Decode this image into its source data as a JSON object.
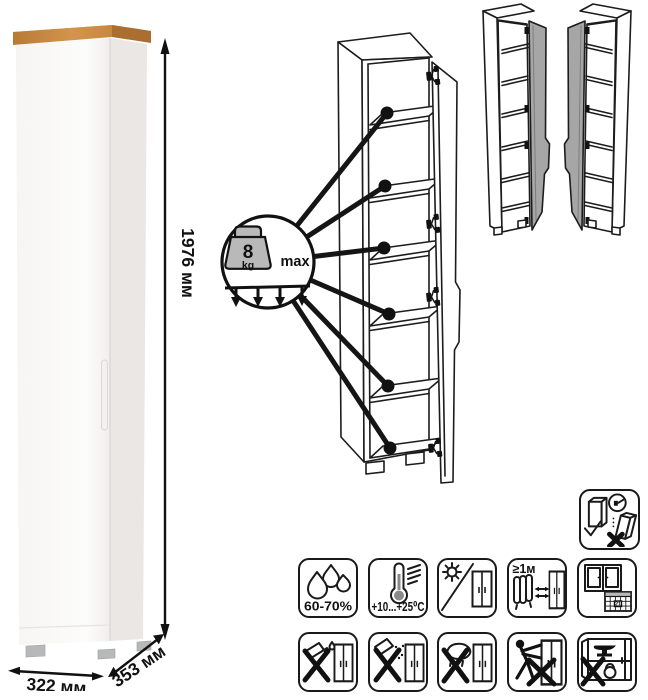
{
  "product_photo": {
    "height_label": "1976 мм",
    "width_label": "322 мм",
    "depth_label": "353 мм"
  },
  "load_badge": {
    "value": "8",
    "unit": "kg",
    "max_label": "max"
  },
  "care_icons": {
    "humidity_label": "60-70%",
    "temperature_label": "+10...+25⁰C",
    "min_distance_label": "≥1м",
    "calendar_day": "21",
    "names": [
      "humidity-range",
      "temperature-range",
      "avoid-direct-sunlight",
      "keep-distance-from-heaters",
      "ventilate-room-calendar",
      "no-aggressive-liquids",
      "no-abrasive-powders",
      "no-wet-cleaning",
      "no-pushing-when-moving",
      "no-heavy-objects",
      "anchor-to-wall"
    ]
  },
  "diagram": {
    "shelf_count": 6,
    "door_variants": 2,
    "max_shelf_load": "8 kg"
  },
  "colors": {
    "wood_top": "#c8873e",
    "cabinet_body": "#fbfbf9",
    "cabinet_side": "#eae7e4",
    "line": "#1a1a1a",
    "variant_door_gray": "#a6a6a6",
    "weight_fill": "#b9b9b9"
  }
}
